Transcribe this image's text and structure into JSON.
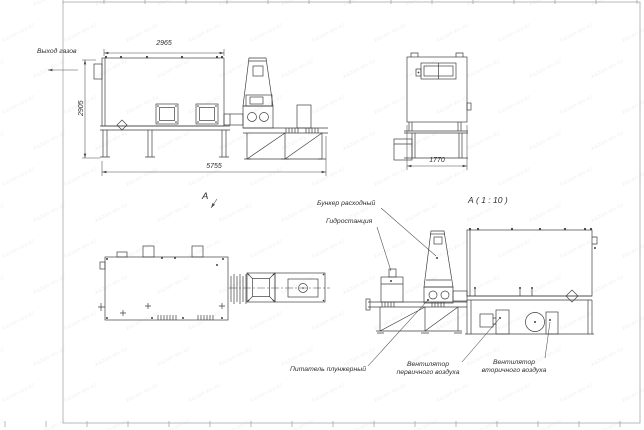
{
  "sheet": {
    "watermark_text": "kazan-wv.kz"
  },
  "main_view": {
    "gas_outlet_label": "Выход газов",
    "dim_width_top": "2965",
    "dim_height_left": "2905",
    "dim_length_bottom": "5755",
    "view_arrow_label": "А"
  },
  "end_view": {
    "dim_width_bottom": "1770"
  },
  "detail_view": {
    "title": "А ( 1 : 10 )",
    "label_hopper": "Бункер расходный",
    "label_hydraulic": "Гидростанция",
    "label_feeder": "Питатель плунжерный",
    "label_primary_fan": "Вентилятор\nпервичного воздуха",
    "label_secondary_fan": "Вентилятор\nвторичного воздуха"
  },
  "colors": {
    "paper": "#ffffff",
    "line": "#3f3f3f",
    "dim": "#4a4a4a",
    "text": "#2e2e2e",
    "frame": "#a8a8a8",
    "watermark": "rgba(70,70,110,0.08)"
  }
}
